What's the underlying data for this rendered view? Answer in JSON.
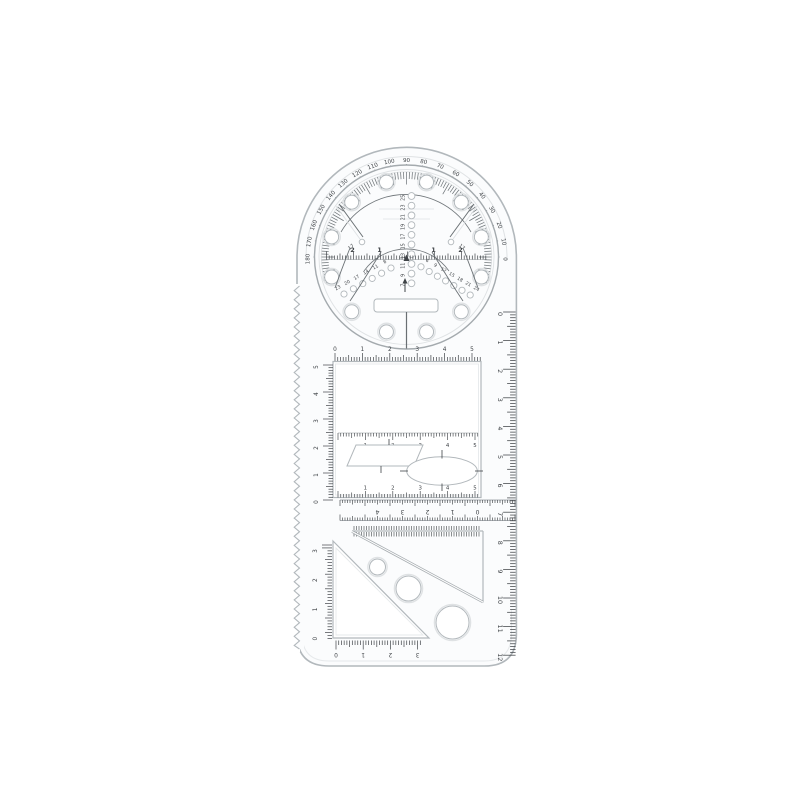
{
  "colors": {
    "background": "#ffffff",
    "body_fill": "#fbfcfd",
    "cutout_fill": "#ffffff",
    "edge": "#b2b8bc",
    "edge_light": "#e6e9eb",
    "ring_light": "#dfe2e4",
    "tick": "#3f4347",
    "tick_soft": "#71777b",
    "disc_ring": "#a4aaae"
  },
  "protractor": {
    "degree_labels": [
      "0",
      "10",
      "20",
      "30",
      "40",
      "50",
      "60",
      "70",
      "80",
      "90",
      "100",
      "110",
      "120",
      "130",
      "140",
      "150",
      "160",
      "170",
      "180"
    ]
  },
  "disc": {
    "center_column_labels": [
      "25",
      "23",
      "21",
      "19",
      "17",
      "15",
      "13",
      "11",
      "9",
      "7"
    ],
    "left_hole_labels": [
      "23",
      "20",
      "17",
      "14",
      "11",
      "8"
    ],
    "right_hole_labels": [
      "6",
      "9",
      "12",
      "15",
      "18",
      "21",
      "24"
    ],
    "left_needle_label": "17",
    "right_needle_label": "17",
    "diameter_scale_labels": [
      "2",
      "1",
      "1",
      "2"
    ]
  },
  "rectangle_section": {
    "top_scale_labels": [
      "0",
      "1",
      "2",
      "3",
      "4",
      "5"
    ],
    "left_scale_labels": [
      "5",
      "4",
      "3",
      "2",
      "1",
      "0"
    ],
    "inner_scale_labels": [
      "1",
      "2",
      "3",
      "4",
      "5"
    ],
    "bottom_scale_labels": [
      "1",
      "2",
      "3",
      "4",
      "5"
    ]
  },
  "cross_ruler_labels": [
    "4",
    "3",
    "2",
    "1",
    "0"
  ],
  "right_ruler_labels": [
    "0",
    "1",
    "2",
    "3",
    "4",
    "5",
    "6",
    "7",
    "8",
    "9",
    "10",
    "11",
    "12"
  ],
  "triangle_section": {
    "vertical_scale_labels": [
      "3",
      "2",
      "1",
      "0"
    ],
    "horizontal_scale_labels": [
      "0",
      "1",
      "2",
      "3"
    ]
  }
}
